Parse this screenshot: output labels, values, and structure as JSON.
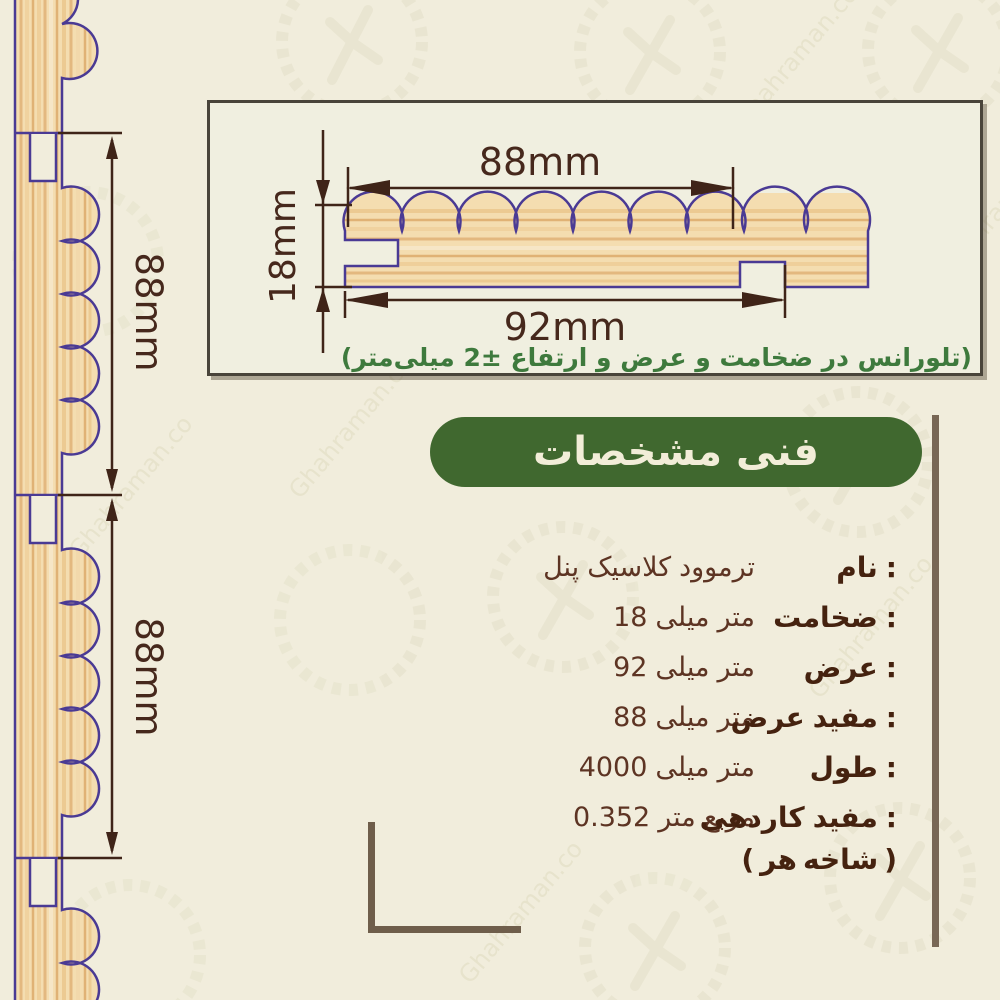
{
  "watermark": {
    "text": "Ghahraman.co"
  },
  "diagram_box": {
    "useful_width_label": "88mm",
    "thickness_label": "18mm",
    "total_width_label": "92mm",
    "tolerance_note": "(تلورانس در ضخامت و عرض و ارتفاع ±2 میلی‌متر)"
  },
  "left_profile": {
    "dim_labels": [
      "88mm",
      "88mm"
    ]
  },
  "title": {
    "text": "مشخصات فنی"
  },
  "specs": {
    "colon": ":",
    "rows": [
      {
        "label": "نام",
        "value": "پنل کلاسیک ترموود"
      },
      {
        "label": "ضخامت",
        "value": "18 میلی متر"
      },
      {
        "label": "عرض",
        "value": "92 میلی متر"
      },
      {
        "label": "عرض مفید",
        "value": "88 میلی متر"
      },
      {
        "label": "طول",
        "value": "4000 میلی متر"
      },
      {
        "label": "کاردهی مفید",
        "value": "0.352 متر مربع"
      }
    ],
    "note": "( هر شاخه )"
  },
  "colors": {
    "background": "#f1eddc",
    "wood_fill": "#f4ddb0",
    "wood_grain": "#e3b87f",
    "outline_indigo": "#4a3a94",
    "dimension_brown": "#3f2418",
    "green_pill": "#40682f",
    "green_text": "#3e7a3d",
    "label_brown": "#45220f",
    "value_brown": "#5d3423",
    "rule_brown": "#786755"
  }
}
